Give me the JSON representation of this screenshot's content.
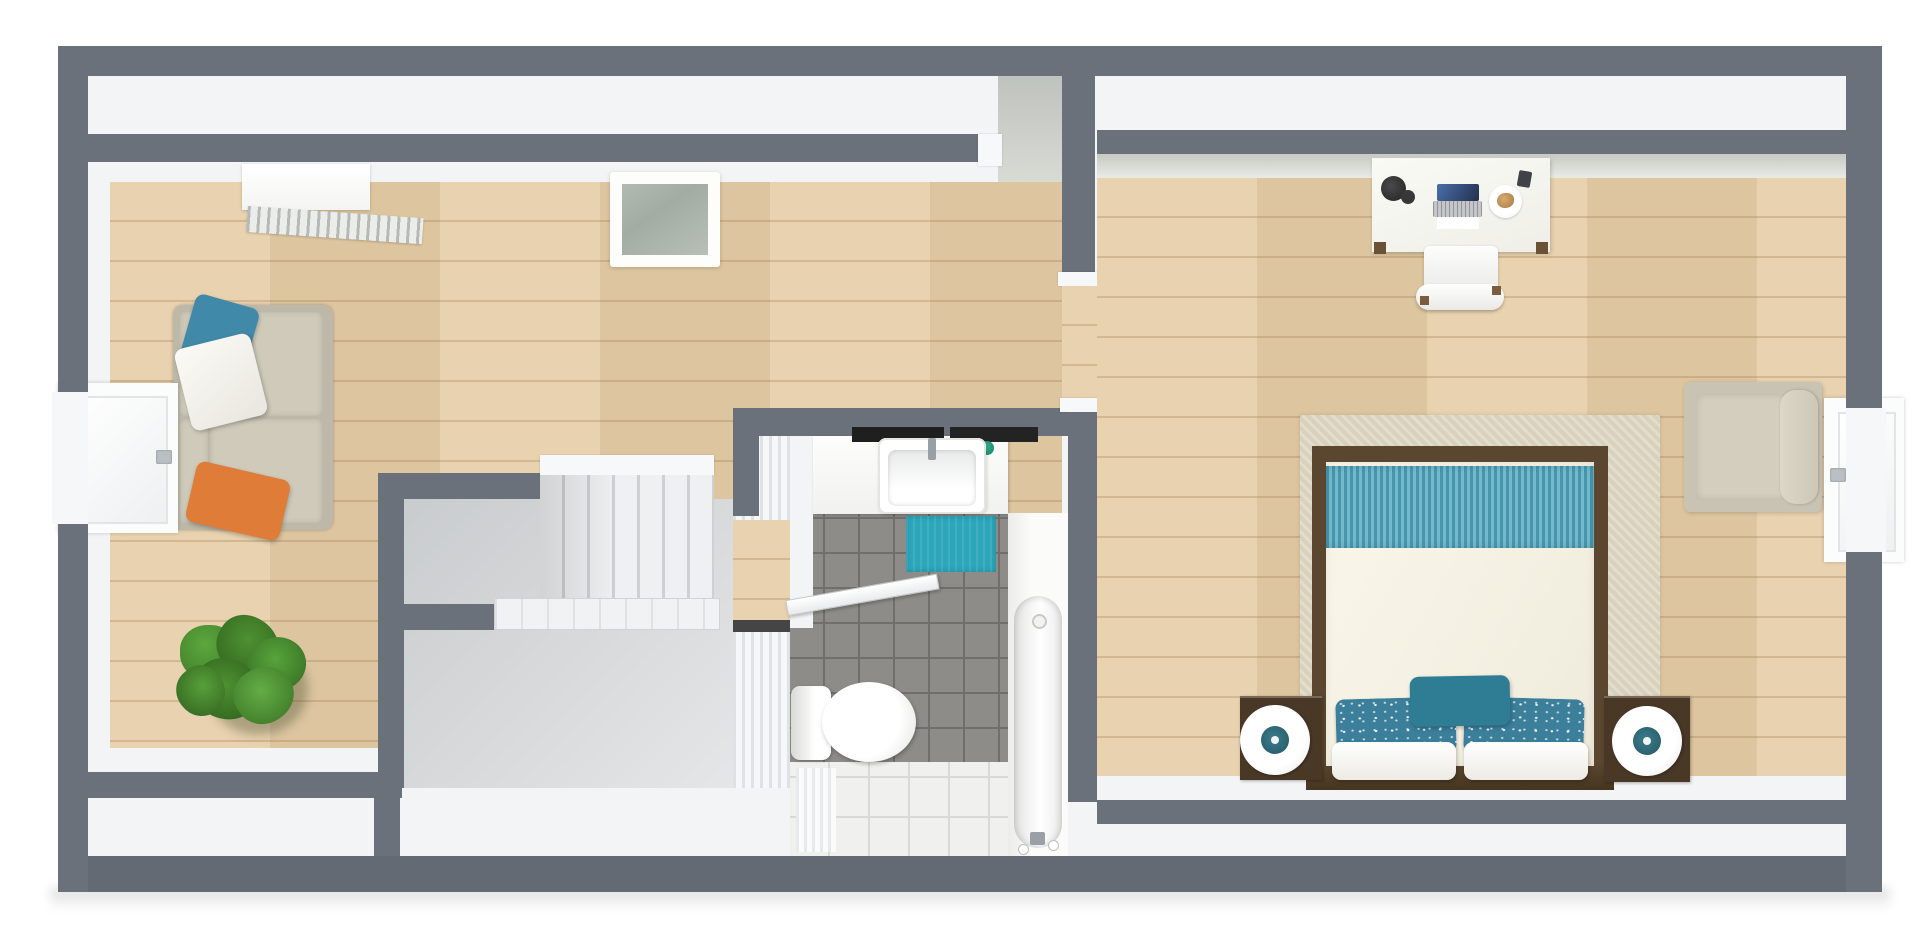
{
  "scene": {
    "type": "3d-floor-plan-top-down-render",
    "description": "Upper floor plan with living landing, staircase, bathroom and bedroom",
    "rooms": [
      {
        "name": "living-landing",
        "objects": [
          "sofa",
          "blue-pillow",
          "white-pillow",
          "orange-pillow",
          "potted-plant",
          "wall-cabinet-with-grille",
          "roof-window",
          "side-window"
        ]
      },
      {
        "name": "staircase",
        "objects": [
          "stairs",
          "railing",
          "half-wall",
          "stairwell-void"
        ]
      },
      {
        "name": "bathroom",
        "objects": [
          "vanity-counter",
          "sink",
          "mirror-strip",
          "teal-bath-mat",
          "toilet",
          "bathtub",
          "tub-faucet",
          "open-door",
          "paneled-balustrade",
          "white-tile-area",
          "striped-mat"
        ]
      },
      {
        "name": "bedroom",
        "objects": [
          "double-bed",
          "teal-blanket-band",
          "floral-pillows",
          "white-pillows",
          "accent-pillow",
          "area-rug",
          "nightstand-left",
          "nightstand-right",
          "round-speaker-left",
          "round-speaker-right",
          "desk",
          "laptop",
          "headphones",
          "plate-with-croissant",
          "phone",
          "desk-chair",
          "armchair",
          "side-window"
        ]
      }
    ]
  },
  "colors": {
    "wall": "#6b717a",
    "wall2": "#646a73",
    "face": "#f3f4f6",
    "cap": "#f7f8f9",
    "wood": "#e6cda6",
    "tile": "#8d8c88",
    "grout": "#716f6b",
    "wtile": "#f0f1ef",
    "wgrout": "#d9dad6",
    "teal": "#2ca6ba",
    "floral": "#3b7f9b",
    "accentpillow": "#2e7d94",
    "duvet": "#f6f2e4",
    "bedwood": "#5b4730",
    "furnwood": "#4a3827",
    "rug": "#d8d2bc",
    "sofa": "#c3beae",
    "orange": "#df7c37",
    "bluepillow": "#4189a8",
    "plantgreen": "#4e9132",
    "speakerteal": "#33707f"
  }
}
